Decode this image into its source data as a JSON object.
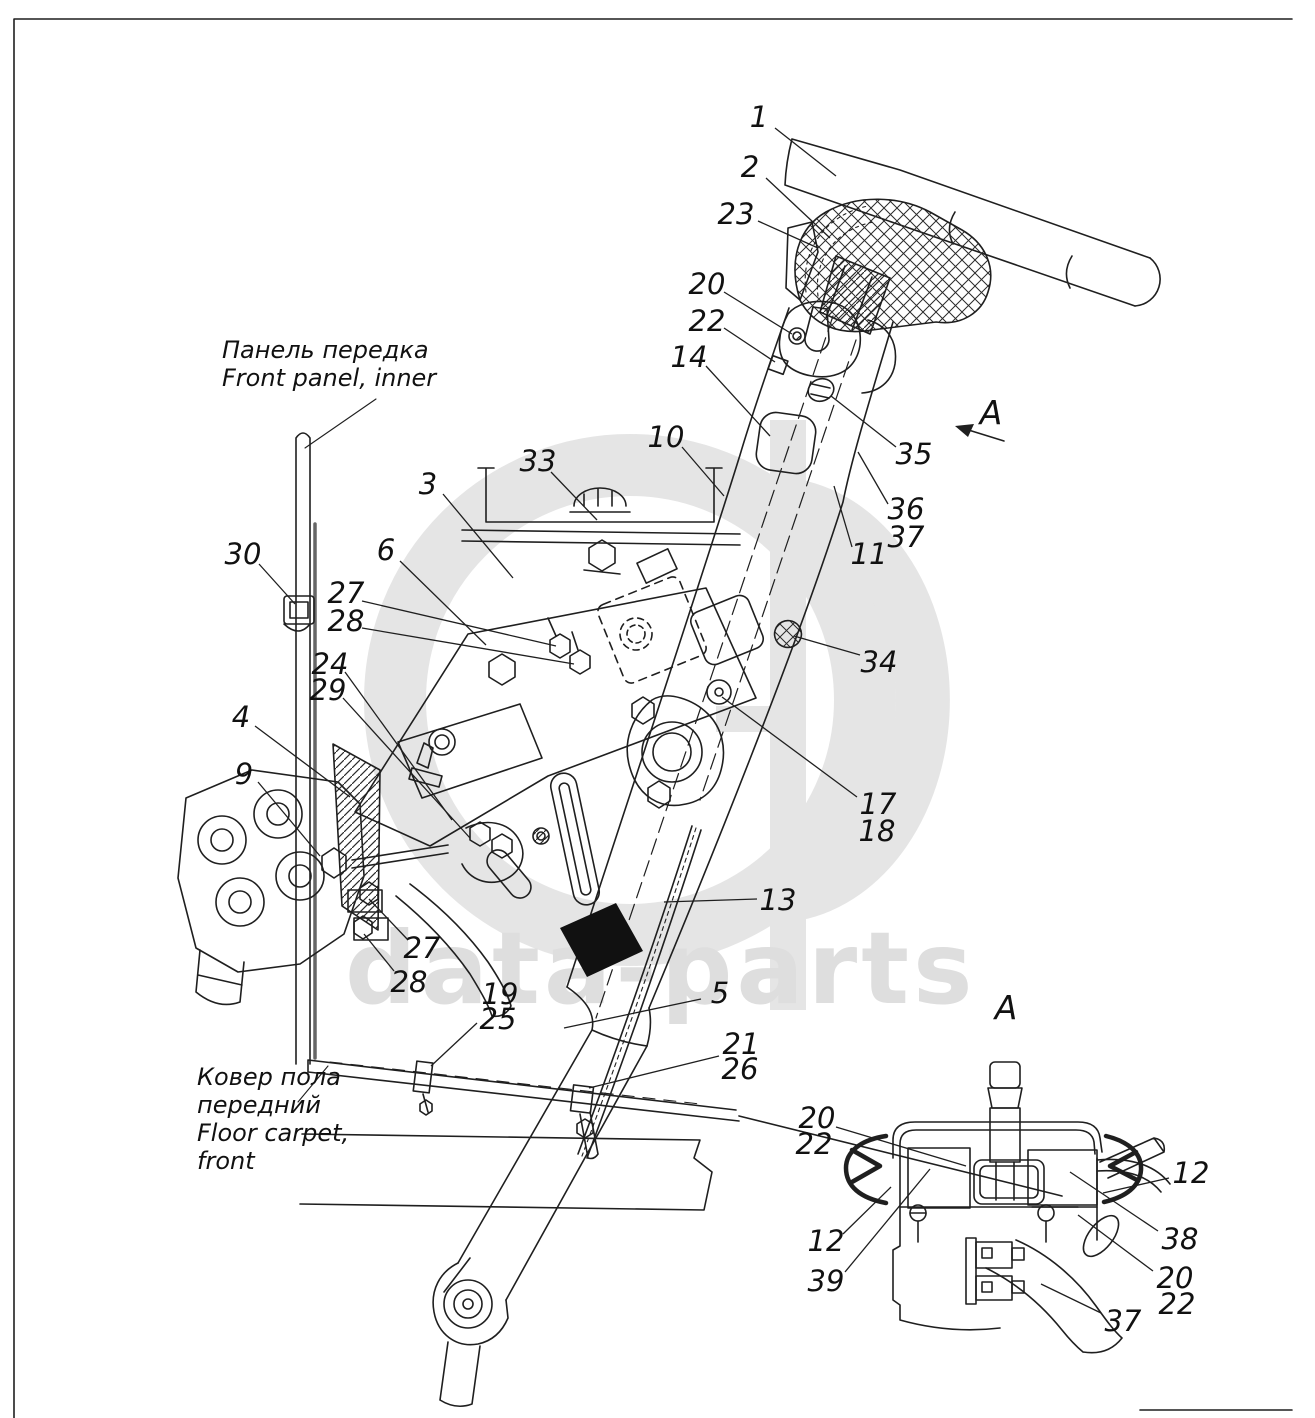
{
  "page": {
    "background": "#ffffff",
    "line_color": "#1f1f1f"
  },
  "watermark": {
    "text": "data-parts",
    "text_color": "#dedede",
    "logo_color": "#e5e5e5"
  },
  "notes": {
    "front_panel": {
      "lines": [
        "Панель передка",
        "Front panel, inner"
      ],
      "x": 222,
      "y": 358,
      "leader": [
        376,
        399,
        305,
        448
      ]
    },
    "floor_carpet": {
      "lines": [
        "Ковер пола",
        "передний",
        "Floor carpet,",
        "front"
      ],
      "x": 197,
      "y": 1085,
      "leader": [
        298,
        1102,
        328,
        1066
      ]
    }
  },
  "view_arrow": {
    "label": "A",
    "x": 991,
    "y": 413
  },
  "detail_view_title": {
    "label": "A",
    "x": 1006,
    "y": 1008
  },
  "callouts": [
    {
      "t": "1",
      "v": "main",
      "x": 759,
      "y": 117,
      "l": [
        775,
        128,
        836,
        176
      ]
    },
    {
      "t": "2",
      "v": "main",
      "x": 750,
      "y": 167,
      "l": [
        766,
        178,
        830,
        238
      ]
    },
    {
      "t": "23",
      "v": "main",
      "x": 736,
      "y": 214,
      "l": [
        758,
        221,
        818,
        248
      ]
    },
    {
      "t": "20",
      "v": "main",
      "x": 707,
      "y": 284,
      "l": [
        724,
        292,
        792,
        334
      ]
    },
    {
      "t": "22",
      "v": "main",
      "x": 707,
      "y": 321,
      "l": [
        724,
        328,
        775,
        362
      ]
    },
    {
      "t": "14",
      "v": "main",
      "x": 689,
      "y": 357,
      "l": [
        706,
        366,
        770,
        436
      ]
    },
    {
      "t": "10",
      "v": "main",
      "x": 666,
      "y": 437,
      "l": [
        682,
        447,
        724,
        496
      ]
    },
    {
      "t": "33",
      "v": "main",
      "x": 538,
      "y": 461,
      "l": [
        551,
        472,
        597,
        520
      ]
    },
    {
      "t": "3",
      "v": "main",
      "x": 428,
      "y": 484,
      "l": [
        443,
        494,
        513,
        578
      ]
    },
    {
      "t": "6",
      "v": "main",
      "x": 386,
      "y": 550,
      "l": [
        400,
        561,
        486,
        645
      ]
    },
    {
      "t": "30",
      "v": "main",
      "x": 243,
      "y": 554,
      "l": [
        259,
        564,
        295,
        604
      ]
    },
    {
      "t": "27",
      "v": "main",
      "x": 346,
      "y": 593,
      "l": [
        362,
        601,
        556,
        646
      ]
    },
    {
      "t": "28",
      "v": "main",
      "x": 346,
      "y": 621,
      "l": [
        362,
        628,
        574,
        664
      ]
    },
    {
      "t": "24",
      "v": "main",
      "x": 330,
      "y": 664,
      "l": [
        345,
        672,
        452,
        820
      ]
    },
    {
      "t": "29",
      "v": "main",
      "x": 328,
      "y": 690,
      "l": [
        343,
        698,
        470,
        838
      ]
    },
    {
      "t": "4",
      "v": "main",
      "x": 241,
      "y": 717,
      "l": [
        255,
        726,
        350,
        797
      ]
    },
    {
      "t": "9",
      "v": "main",
      "x": 244,
      "y": 774,
      "l": [
        258,
        782,
        320,
        856
      ]
    },
    {
      "t": "35",
      "v": "main",
      "x": 914,
      "y": 454,
      "l": [
        896,
        447,
        831,
        396
      ]
    },
    {
      "t": "36",
      "v": "main",
      "x": 906,
      "y": 509,
      "l": [
        888,
        504,
        858,
        452
      ]
    },
    {
      "t": "37",
      "v": "main",
      "x": 906,
      "y": 537
    },
    {
      "t": "11",
      "v": "main",
      "x": 869,
      "y": 554,
      "l": [
        852,
        547,
        834,
        486
      ]
    },
    {
      "t": "34",
      "v": "main",
      "x": 879,
      "y": 662,
      "l": [
        860,
        655,
        794,
        636
      ]
    },
    {
      "t": "17",
      "v": "main",
      "x": 878,
      "y": 804,
      "l": [
        857,
        797,
        722,
        697
      ]
    },
    {
      "t": "18",
      "v": "main",
      "x": 877,
      "y": 831
    },
    {
      "t": "13",
      "v": "main",
      "x": 778,
      "y": 900,
      "l": [
        757,
        899,
        664,
        902
      ]
    },
    {
      "t": "27",
      "v": "main",
      "x": 422,
      "y": 948,
      "l": [
        408,
        940,
        369,
        899
      ]
    },
    {
      "t": "28",
      "v": "main",
      "x": 409,
      "y": 982,
      "l": [
        394,
        971,
        364,
        934
      ]
    },
    {
      "t": "19",
      "v": "main",
      "x": 500,
      "y": 994
    },
    {
      "t": "25",
      "v": "main",
      "x": 498,
      "y": 1019,
      "l": [
        477,
        1023,
        431,
        1066
      ]
    },
    {
      "t": "5",
      "v": "main",
      "x": 720,
      "y": 993,
      "l": [
        701,
        999,
        564,
        1028
      ]
    },
    {
      "t": "21",
      "v": "main",
      "x": 741,
      "y": 1044
    },
    {
      "t": "26",
      "v": "main",
      "x": 740,
      "y": 1069,
      "l": [
        719,
        1056,
        589,
        1088
      ]
    },
    {
      "t": "20",
      "v": "detail",
      "x": 817,
      "y": 1118
    },
    {
      "t": "22",
      "v": "detail",
      "x": 814,
      "y": 1144,
      "l": [
        836,
        1127,
        966,
        1166
      ]
    },
    {
      "t": "12",
      "v": "detail",
      "x": 826,
      "y": 1241,
      "l": [
        843,
        1234,
        891,
        1187
      ]
    },
    {
      "t": "39",
      "v": "detail",
      "x": 826,
      "y": 1281,
      "l": [
        845,
        1272,
        930,
        1169
      ]
    },
    {
      "t": "12",
      "v": "detail",
      "x": 1191,
      "y": 1173,
      "l": [
        1169,
        1178,
        1103,
        1193
      ]
    },
    {
      "t": "38",
      "v": "detail",
      "x": 1180,
      "y": 1239,
      "l": [
        1158,
        1231,
        1070,
        1172
      ]
    },
    {
      "t": "20",
      "v": "detail",
      "x": 1175,
      "y": 1278,
      "l": [
        1153,
        1271,
        1078,
        1215
      ]
    },
    {
      "t": "22",
      "v": "detail",
      "x": 1177,
      "y": 1304
    },
    {
      "t": "37",
      "v": "detail",
      "x": 1123,
      "y": 1321,
      "l": [
        1101,
        1313,
        1041,
        1284
      ]
    }
  ]
}
